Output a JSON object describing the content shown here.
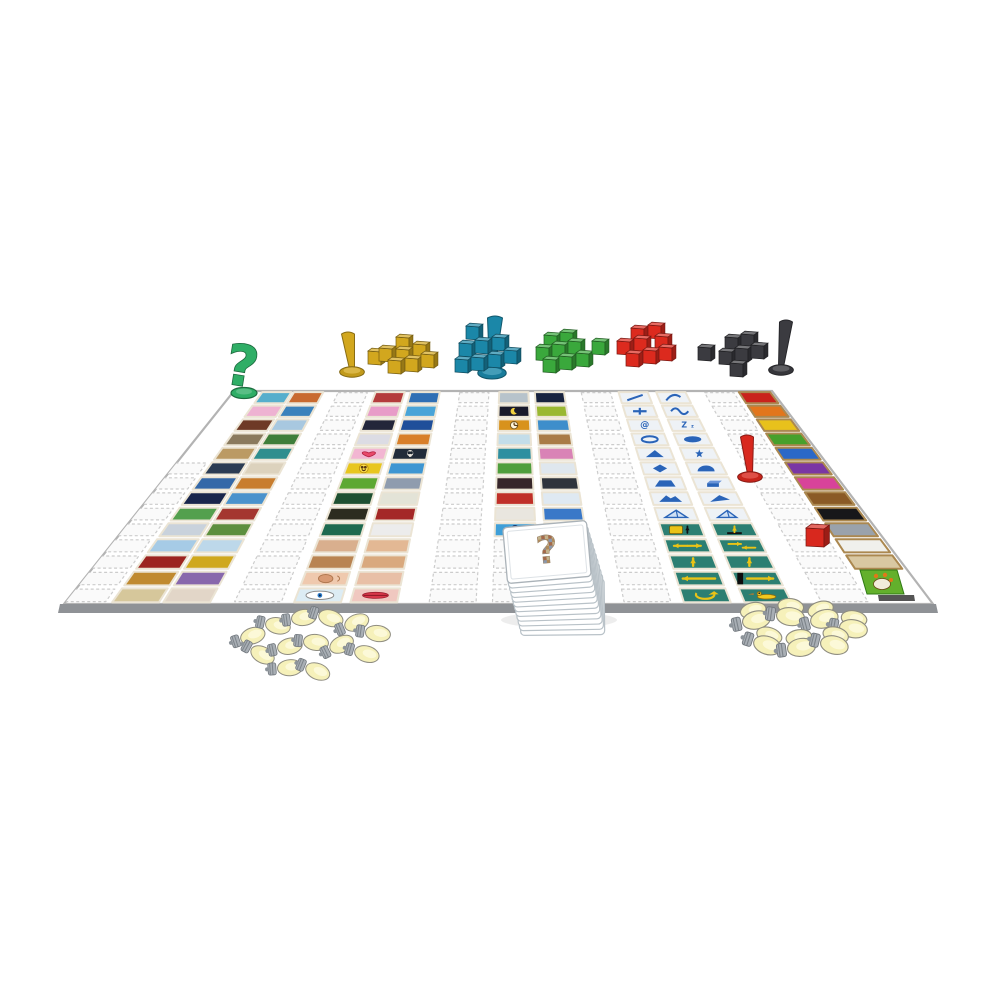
{
  "background": "#ffffff",
  "board": {
    "corners": {
      "tl": [
        234,
        391
      ],
      "tr": [
        772,
        391
      ],
      "br": [
        933,
        604
      ],
      "bl": [
        64,
        604
      ]
    },
    "surface": "#ffffff",
    "edge_stroke": "#b3b3b3",
    "front_band": "#8f9296",
    "rows": 14,
    "slot_fill": "#fafafa",
    "slot_stroke": "#cccccc"
  },
  "tile_frame": "#ebe4d4",
  "color_tile_frame": "#ab8850",
  "glyph_blue": "#2a64b8",
  "glyph_yellow": "#eac316",
  "columns": [
    {
      "name": "scenes-left-outer",
      "u": 0.054,
      "du": 0.054,
      "tiles": [
        [
          "#56aecc"
        ],
        [
          "#eeb2d2"
        ],
        [
          "#6e3a26"
        ],
        [
          "#8a7a5e"
        ],
        [
          "#bb9a64"
        ],
        [
          "#2b3c54"
        ],
        [
          "#3468a8"
        ],
        [
          "#19264c"
        ],
        [
          "#53a04e"
        ],
        [
          "#c9d2dc"
        ],
        [
          "#a6cbe6"
        ],
        [
          "#9c2420"
        ],
        [
          "#c08a30"
        ],
        [
          "#d6c79b"
        ]
      ]
    },
    {
      "name": "scenes-left-inner",
      "u": 0.113,
      "du": 0.054,
      "tiles": [
        [
          "#c86a30"
        ],
        [
          "#3b82bc"
        ],
        [
          "#a8c8e0"
        ],
        [
          "#3f7e3a"
        ],
        [
          "#2f8e8e"
        ],
        [
          "#dcd2bd"
        ],
        [
          "#c87d2e"
        ],
        [
          "#4a92cc"
        ],
        [
          "#a43630"
        ],
        [
          "#5d8f3e"
        ],
        [
          "#bdd8ea"
        ],
        [
          "#cfa81e"
        ],
        [
          "#8868ac"
        ],
        [
          "#e2d6c8"
        ]
      ]
    },
    {
      "name": "things-mid-outer",
      "u": 0.264,
      "du": 0.054,
      "tiles": [
        [
          "#b43c3c"
        ],
        [
          "#e89cc8"
        ],
        [
          "#23263a"
        ],
        [
          "#dcdce4"
        ],
        [
          "#f2b6d2",
          "heart"
        ],
        [
          "#e8c61e",
          "smiley"
        ],
        [
          "#5da832"
        ],
        [
          "#1e5032"
        ],
        [
          "#2c2c20"
        ],
        [
          "#1e6a50"
        ],
        [
          "#d9af8e"
        ],
        [
          "#b98452"
        ],
        [
          "#efc9ae",
          "ear"
        ],
        [
          "#dcecf4",
          "eye"
        ]
      ]
    },
    {
      "name": "things-mid-inner",
      "u": 0.329,
      "du": 0.054,
      "tiles": [
        [
          "#2f6fb4"
        ],
        [
          "#49a4d8"
        ],
        [
          "#1f4f9a"
        ],
        [
          "#d87f2a"
        ],
        [
          "#222c3a",
          "skull"
        ],
        [
          "#3e96d2"
        ],
        [
          "#8f9cae"
        ],
        [
          "#e3e3d7"
        ],
        [
          "#a42828"
        ],
        [
          "#ececec"
        ],
        [
          "#e3b894"
        ],
        [
          "#d9a97e"
        ],
        [
          "#e8bfa6"
        ],
        [
          "#f0c8c0",
          "lips"
        ]
      ]
    },
    {
      "name": "center-left",
      "u": 0.493,
      "du": 0.054,
      "tiles": [
        [
          "#b7c3cb"
        ],
        [
          "#191a2b",
          "moon"
        ],
        [
          "#d8921c",
          "clock"
        ],
        [
          "#c3dde9"
        ],
        [
          "#2e8fa0"
        ],
        [
          "#4f9e3c"
        ],
        [
          "#37262a"
        ],
        [
          "#c03028"
        ],
        [
          "#e9e6df"
        ],
        [
          "#3f9fd8",
          "num0"
        ]
      ]
    },
    {
      "name": "center-right",
      "u": 0.559,
      "du": 0.054,
      "tiles": [
        [
          "#18233f"
        ],
        [
          "#9ab832"
        ],
        [
          "#3e8ecb"
        ],
        [
          "#a97b46"
        ],
        [
          "#d983b6"
        ],
        [
          "#dfe7ee"
        ],
        [
          "#2f343c"
        ],
        [
          "#dfe9f2"
        ],
        [
          "#3a78c8"
        ],
        [
          "#3f9fd8",
          "num1"
        ]
      ]
    },
    {
      "name": "symbols-left",
      "u": 0.714,
      "du": 0.054,
      "tiles": [
        [
          "#eef2f6",
          "line"
        ],
        [
          "#eef2f6",
          "plus"
        ],
        [
          "#eef2f6",
          "at"
        ],
        [
          "#eef2f6",
          "oval"
        ],
        [
          "#eef2f6",
          "tri"
        ],
        [
          "#eef2f6",
          "diamond"
        ],
        [
          "#eef2f6",
          "trap"
        ],
        [
          "#eef2f6",
          "ridge"
        ],
        [
          "#eef2f6",
          "pyramid"
        ],
        [
          "#2c7f72",
          "boxarrow"
        ],
        [
          "#2c7f72",
          "arrow-lr"
        ],
        [
          "#2c7f72",
          "arrow-up"
        ],
        [
          "#2c7f72",
          "arrow-longl"
        ],
        [
          "#2c7f72",
          "cycle"
        ]
      ]
    },
    {
      "name": "symbols-right",
      "u": 0.784,
      "du": 0.054,
      "tiles": [
        [
          "#eef2f6",
          "curve"
        ],
        [
          "#eef2f6",
          "wave"
        ],
        [
          "#eef2f6",
          "ztwo"
        ],
        [
          "#eef2f6",
          "blob"
        ],
        [
          "#eef2f6",
          "star"
        ],
        [
          "#eef2f6",
          "dome"
        ],
        [
          "#eef2f6",
          "cube"
        ],
        [
          "#eef2f6",
          "prism"
        ],
        [
          "#eef2f6",
          "tent"
        ],
        [
          "#2c7f72",
          "arrow-sm"
        ],
        [
          "#2c7f72",
          "arrow-opp"
        ],
        [
          "#2c7f72",
          "arrow-up"
        ],
        [
          "#2c7f72",
          "arrow-longr"
        ],
        [
          "#2c7f72",
          "duck"
        ]
      ]
    },
    {
      "name": "colors",
      "u": 0.937,
      "du": 0.058,
      "frame": "#ab8850",
      "tiles": [
        [
          "#c9231c"
        ],
        [
          "#e2761c"
        ],
        [
          "#e8c11c"
        ],
        [
          "#47a02c"
        ],
        [
          "#2a68c8"
        ],
        [
          "#7a36a4"
        ],
        [
          "#d8439a"
        ],
        [
          "#8a5a26"
        ],
        [
          "#17171a"
        ],
        [
          "#9aa2ab"
        ],
        [
          "#f0f0ec"
        ],
        [
          "#d9c8a2"
        ]
      ]
    }
  ],
  "slot_columns": [
    {
      "u": -0.002,
      "du": 0.048,
      "from": 5,
      "to": 13
    },
    {
      "u": 0.195,
      "du": 0.054,
      "from": 0,
      "to": 13
    },
    {
      "u": 0.42,
      "du": 0.054,
      "from": 0,
      "to": 13
    },
    {
      "u": 0.645,
      "du": 0.054,
      "from": 0,
      "to": 13
    },
    {
      "u": 0.873,
      "du": 0.054,
      "from": 0,
      "to": 13
    },
    {
      "u": 0.493,
      "du": 0.054,
      "from": 10,
      "to": 13
    },
    {
      "u": 0.559,
      "du": 0.054,
      "from": 10,
      "to": 13
    }
  ],
  "question_pawn": {
    "hex": "#2fae66",
    "x": 244,
    "y": 393,
    "glyph": "?",
    "size": 56
  },
  "cube_groups": [
    {
      "name": "yellow",
      "hex": "#d2a71e",
      "pawn": {
        "x": 352,
        "y": 372,
        "h": 38,
        "tw": 13,
        "lean": -4
      },
      "cubes": [
        [
          368,
          364
        ],
        [
          396,
          350
        ],
        [
          379,
          361
        ],
        [
          396,
          362
        ],
        [
          413,
          357
        ],
        [
          388,
          373
        ],
        [
          405,
          371
        ],
        [
          421,
          367
        ]
      ]
    },
    {
      "name": "teal",
      "hex": "#1b87a8",
      "pawn": {
        "x": 492,
        "y": 373,
        "h": 55,
        "tw": 15,
        "lean": 3
      },
      "cubes": [
        [
          466,
          339
        ],
        [
          459,
          356
        ],
        [
          475,
          353
        ],
        [
          492,
          350
        ],
        [
          455,
          372
        ],
        [
          471,
          370
        ],
        [
          488,
          367
        ],
        [
          504,
          363
        ]
      ]
    },
    {
      "name": "green",
      "hex": "#3aa83c",
      "cubes": [
        [
          544,
          348
        ],
        [
          560,
          345
        ],
        [
          536,
          360
        ],
        [
          552,
          357
        ],
        [
          568,
          354
        ],
        [
          543,
          372
        ],
        [
          559,
          369
        ],
        [
          576,
          366
        ],
        [
          592,
          354
        ]
      ]
    },
    {
      "name": "red",
      "hex": "#dc2a1e",
      "cubes": [
        [
          631,
          341
        ],
        [
          648,
          338
        ],
        [
          617,
          354
        ],
        [
          634,
          351
        ],
        [
          655,
          349
        ],
        [
          626,
          366
        ],
        [
          643,
          363
        ],
        [
          659,
          360
        ]
      ]
    },
    {
      "name": "black",
      "hex": "#3b3b40",
      "pawn": {
        "x": 781,
        "y": 370,
        "h": 48,
        "tw": 13,
        "lean": 5
      },
      "cubes": [
        [
          698,
          360
        ],
        [
          725,
          350
        ],
        [
          741,
          347
        ],
        [
          719,
          364
        ],
        [
          735,
          361
        ],
        [
          751,
          358
        ],
        [
          730,
          376
        ]
      ]
    }
  ],
  "board_pieces": {
    "red_pawn": {
      "hex": "#d8281e",
      "x": 750,
      "y": 477,
      "h": 40,
      "tw": 13,
      "lean": -3
    },
    "red_cube": {
      "hex": "#d8281e",
      "x": 806,
      "y": 546,
      "s": 18
    }
  },
  "card_deck": {
    "x": 505,
    "y": 524,
    "w": 84,
    "h": 56,
    "count": 12,
    "dx": 1.4,
    "dy": 5.0,
    "rot": -5,
    "card_fill": "#ffffff",
    "card_stroke": "#b9c2c8",
    "inner_stroke": "#dde2e6",
    "question_glyph": "?",
    "mosaic_colors": [
      "#b08a5a",
      "#8a98ac",
      "#c2b28c",
      "#a46a4a"
    ]
  },
  "lightbulbs": {
    "glass": "#f6f1ba",
    "glass_hi": "#fcf9d8",
    "base": "#a9afb5",
    "outline": "#8f8d80",
    "left": [
      [
        249,
        637,
        -18
      ],
      [
        274,
        625,
        12
      ],
      [
        300,
        618,
        -8
      ],
      [
        327,
        617,
        18
      ],
      [
        353,
        624,
        -22
      ],
      [
        374,
        633,
        8
      ],
      [
        259,
        653,
        28
      ],
      [
        286,
        647,
        -12
      ],
      [
        312,
        642,
        6
      ],
      [
        338,
        646,
        -26
      ],
      [
        363,
        653,
        16
      ],
      [
        286,
        668,
        -4
      ],
      [
        314,
        670,
        22
      ]
    ],
    "right": [
      [
        752,
        621,
        -12
      ],
      [
        786,
        616,
        8
      ],
      [
        820,
        620,
        -15
      ],
      [
        849,
        628,
        10
      ],
      [
        763,
        644,
        18
      ],
      [
        797,
        648,
        -8
      ],
      [
        830,
        644,
        14
      ]
    ],
    "right_double": true
  },
  "logo": {
    "green": "#63b02c",
    "green_edge": "#2f7a14",
    "cream": "#f2ecda",
    "accent": "#e07818",
    "text_band": "#555555"
  }
}
